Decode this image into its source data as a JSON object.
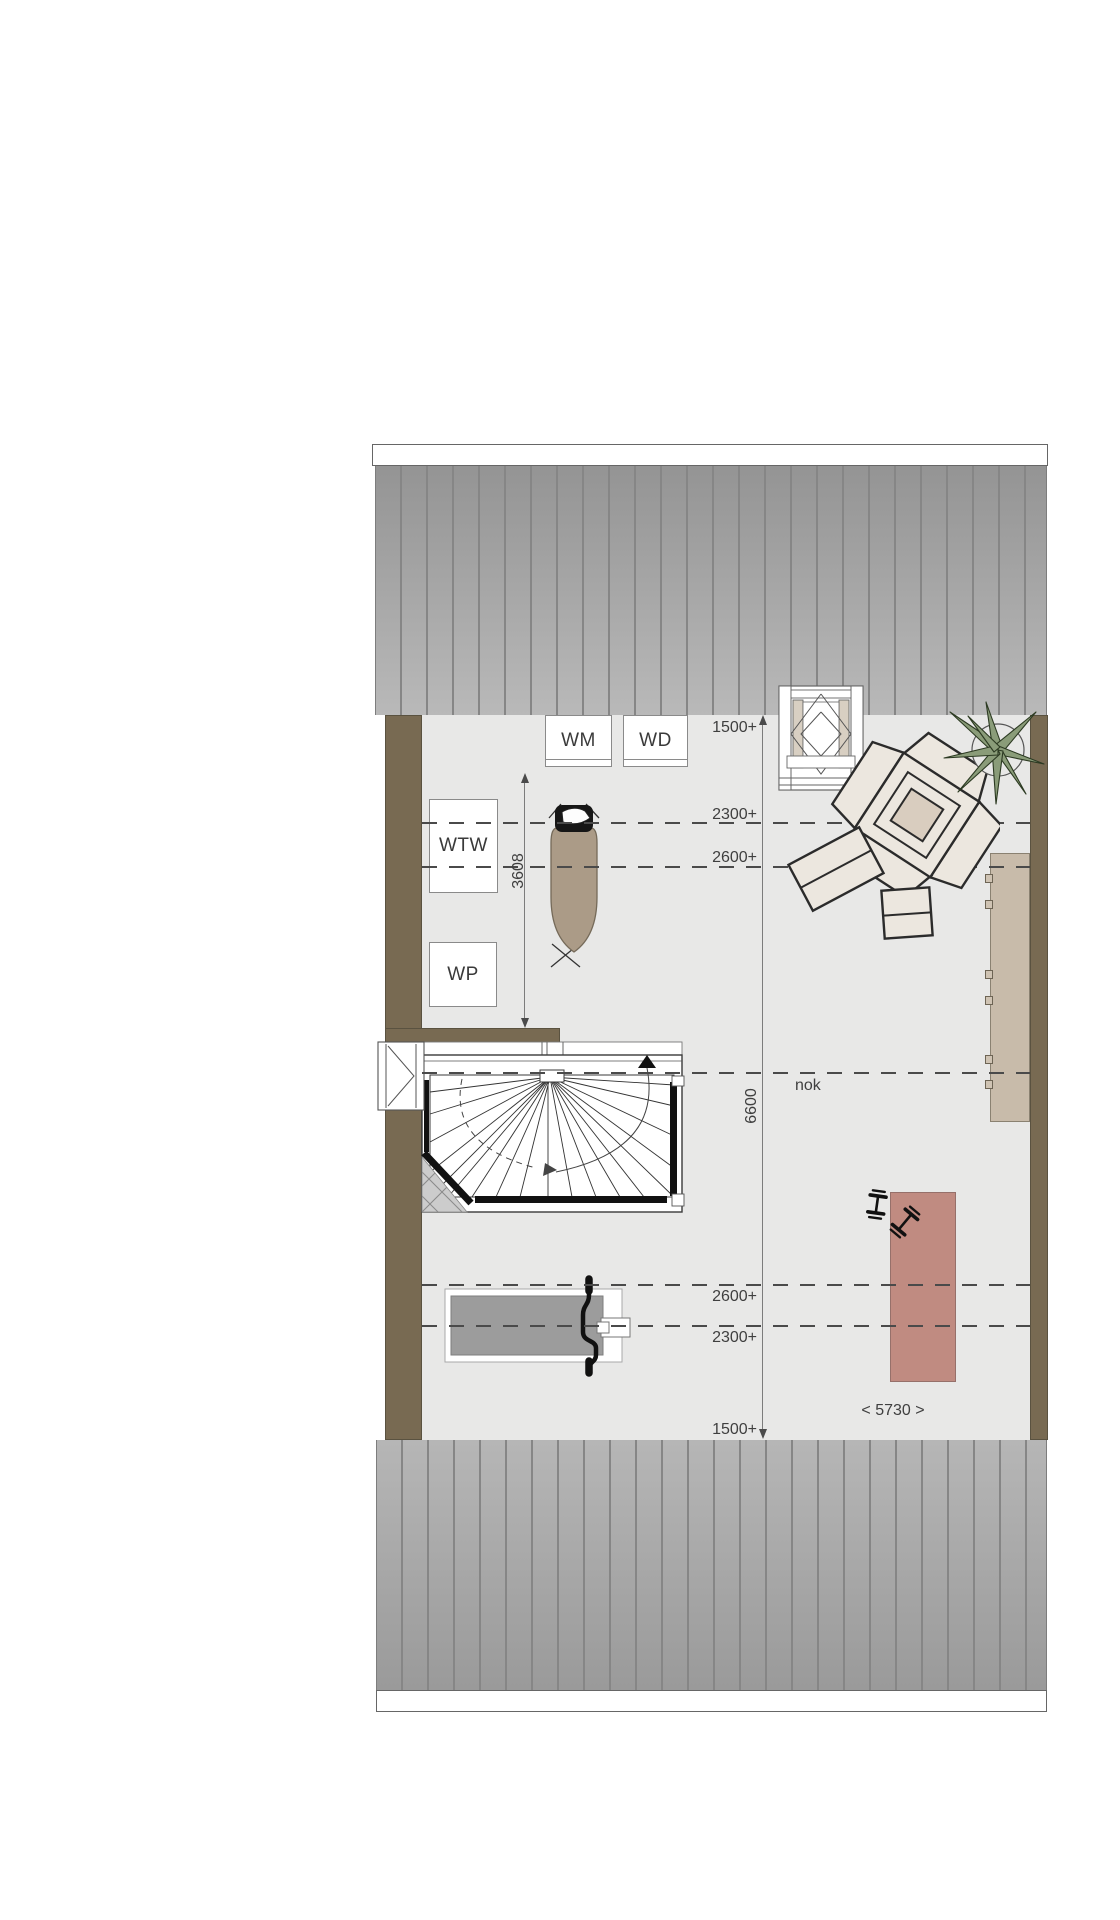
{
  "plan": {
    "type": "attic-floor-plan",
    "appliance_labels": {
      "wm": "WM",
      "wd": "WD",
      "wtw": "WTW",
      "wp": "WP"
    },
    "dimension_labels": {
      "top_1500": "1500+",
      "top_2300": "2300+",
      "top_2600": "2600+",
      "bottom_2600": "2600+",
      "bottom_2300": "2300+",
      "bottom_1500": "1500+",
      "vertical_3608": "3608",
      "vertical_6600": "6600",
      "ridge": "nok",
      "width": "< 5730 >"
    },
    "colors": {
      "roof_gray": "#a6a6a6",
      "roof_seam": "#868686",
      "floor": "#e8e8e7",
      "wall_brown": "#786a52",
      "furniture_cream": "#ece7df",
      "furniture_outline": "#2b2b2b",
      "armchair_center": "#d9cdbf",
      "sideboard_beige": "#c8bbaa",
      "mat_red": "#c08b81",
      "plant_green": "#8a9c79",
      "bench_pad_gray": "#9c9c9c",
      "ironing_board_taupe": "#ab9b87",
      "dimension_text": "#3f3f3f",
      "dash_line": "#4a4a4a"
    }
  }
}
